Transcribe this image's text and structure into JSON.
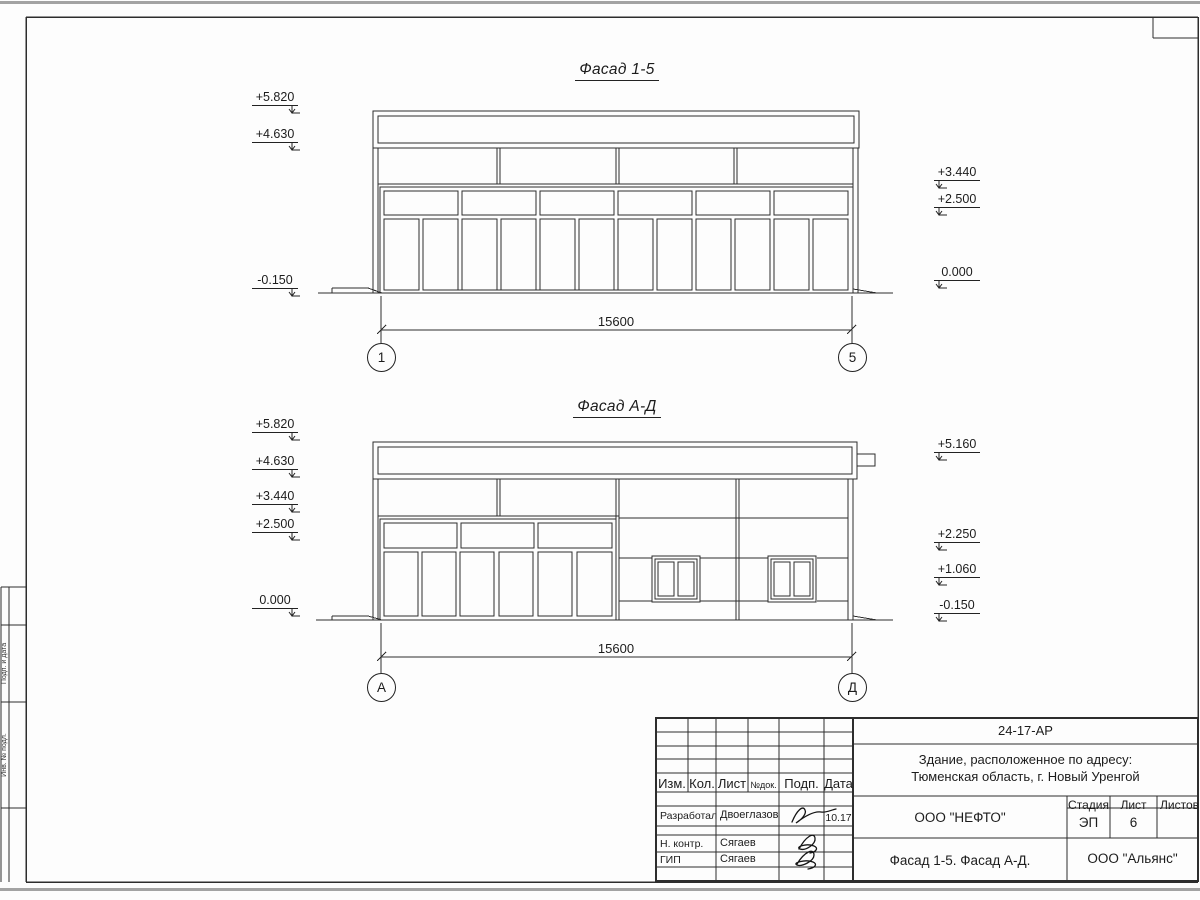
{
  "drawing": {
    "facade_1_5": {
      "title": "Фасад 1-5",
      "dimension_label": "15600",
      "axis_left_label": "1",
      "axis_right_label": "5",
      "elev_left": [
        "+5.820",
        "+4.630",
        "-0.150"
      ],
      "elev_right": [
        "+3.440",
        "+2.500",
        "0.000"
      ]
    },
    "facade_a_d": {
      "title": "Фасад А-Д",
      "dimension_label": "15600",
      "axis_left_label": "А",
      "axis_right_label": "Д",
      "elev_left": [
        "+5.820",
        "+4.630",
        "+3.440",
        "+2.500",
        "0.000"
      ],
      "elev_right": [
        "+5.160",
        "+2.250",
        "+1.060",
        "-0.150"
      ]
    }
  },
  "title_block": {
    "doc_number": "24-17-АР",
    "object_line1": "Здание, расположенное по адресу:",
    "object_line2": "Тюменская область, г. Новый Уренгой",
    "col_izm": "Изм.",
    "col_kol": "Кол.",
    "col_list": "Лист",
    "col_ndok": "№док.",
    "col_podp": "Подп.",
    "col_data": "Дата",
    "row1_role": "Разработал",
    "row1_name": "Двоеглазов",
    "row1_date": "10.17",
    "row2_role": "Н. контр.",
    "row2_name": "Сягаев",
    "row3_role": "ГИП",
    "row3_name": "Сягаев",
    "developer": "ООО \"НЕФТО\"",
    "stage_label": "Стадия",
    "sheet_label": "Лист",
    "sheets_label": "Листов",
    "stage_value": "ЭП",
    "sheet_value": "6",
    "sheet_title": "Фасад 1-5. Фасад А-Д.",
    "contractor": "ООО \"Альянс\""
  },
  "margin_stamp": {
    "cell1": "Подп. и дата",
    "cell2": "Инв. № подл."
  }
}
